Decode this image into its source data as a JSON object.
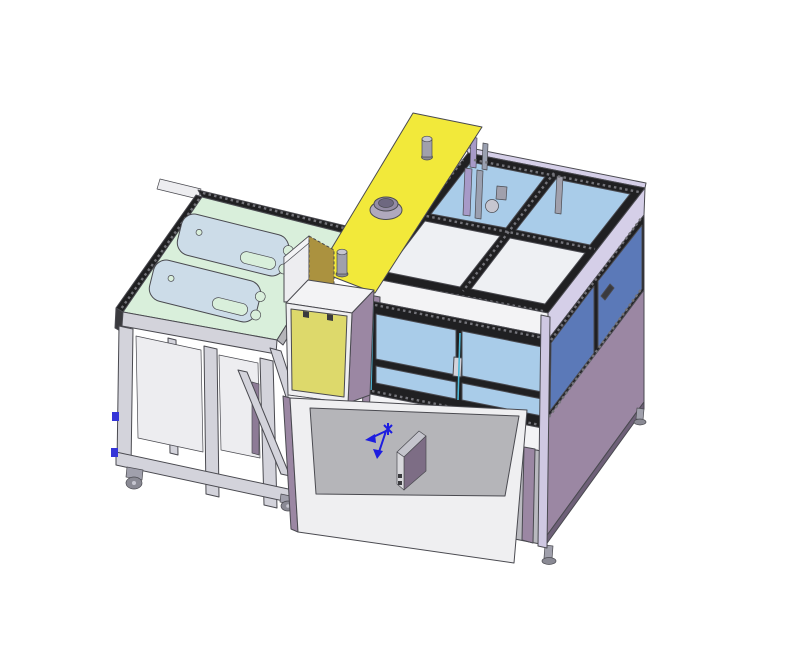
{
  "meta": {
    "scene": "3d-cad-isometric-machine-assembly",
    "background": "#ffffff"
  },
  "colors": {
    "edge": "#4a4a50",
    "frame_dark": "#202022",
    "glass_light": "#a9cce9",
    "glass_dark": "#5b79b8",
    "panel_white": "#eef0f3",
    "white_band": "#f3f3f5",
    "lavender": "#d5cfe8",
    "lavender_post": "#cfc8e2",
    "purple_panel": "#9b87a3",
    "purple_dark": "#6e6078",
    "purple_strip": "#8d7b96",
    "yellow_plate": "#f2e93a",
    "yellow_door": "#ddd96b",
    "tan_block": "#ab923f",
    "mint_top": "#d9efdb",
    "fixture_plate": "#ccdce8",
    "gray_light": "#d3d3db",
    "gray_mid": "#b5b5b9",
    "gray_panel": "#ededf0",
    "door_white": "#efeff1",
    "metal": "#a0a0ac",
    "metal_light": "#c6c6d0",
    "metal_dark": "#8a8a94",
    "bay_gray": "#b9b9bf",
    "shadow": "#9b9ba3",
    "boss_gray": "#b0a9bd",
    "boss_mid": "#948ca4",
    "boss_hole": "#6e6880",
    "accent_cyan": "#49b8d8",
    "accent_blue_tick": "#3535d8",
    "origin_blue": "#1d1de0"
  },
  "parts": {
    "enclosure": "glazed-safety-enclosure",
    "roof_glass": "roof-glass-panels",
    "front_windows": "front-glass-windows",
    "side_windows": "side-glass-windows",
    "base_panel": "purple-base-panel",
    "table": "fixture-table-with-casters",
    "tabletop": "green-tabletop",
    "fixture_plates": "workpiece-fixture-plates",
    "yellow_plate": "yellow-mounting-plate",
    "boss": "cylindrical-boss",
    "pins": "guide-pins",
    "cabinet": "yellow-door-cabinet",
    "open_door": "open-access-door",
    "origin": "origin-triad-marker",
    "component_box": "small-component-box"
  }
}
